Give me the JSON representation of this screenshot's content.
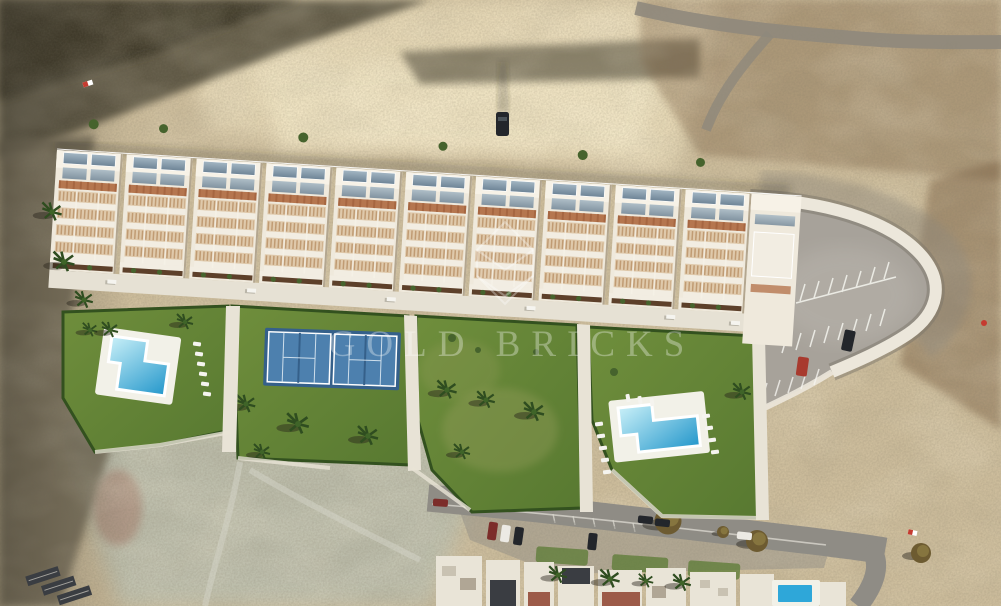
{
  "image": {
    "kind": "aerial-3d-render",
    "description": "Aerial render of a new hillside townhouse development with two L-shaped pools, two padel courts, landscaped gardens and a private parking lot, set in arid badlands above an existing residential street.",
    "watermark": {
      "text": "GOLD BRICKS",
      "logo": "gold-bricks-diamond-logo"
    }
  },
  "scene": {
    "counts": {
      "townhouse_blocks": 10,
      "pools": 2,
      "padel_courts": 2,
      "garden_plots": 4
    }
  },
  "palette": {
    "sand": "#cdbd9c",
    "sand_light": "#e6d8b6",
    "sand_bright": "#f1e5c4",
    "scrub_dark": "#55503e",
    "scrub_darker": "#3f3b2c",
    "pale_green": "#bcbfae",
    "left_slope": "#756c58",
    "brown_scrub": "#7d6244",
    "slope_grey": "#8f887c",
    "building_white": "#efe9dc",
    "roof_bright": "#f7f2e7",
    "glass_top": "#a3b6c3",
    "glass_bot": "#6e8496",
    "pergola": "#b5764f",
    "pergola_dark": "#9d5c38",
    "lattice": "#dfc9ab",
    "lattice_dot": "#b08456",
    "terrace_white": "#f2ede2",
    "planter": "#5d402a",
    "bush": "#46632d",
    "block_gap": "#b3a68f",
    "lawn": "#6f8e3c",
    "lawn_dark": "#587931",
    "lawn_dry": "#9aa05f",
    "hedge": "#33511f",
    "pool_light": "#c9f0f8",
    "pool_deep": "#2497cb",
    "deck": "#f2f1e8",
    "court": "#4d80ae",
    "court_dark": "#35608a",
    "court_line": "#dce9f2",
    "path": "#e8e3d6",
    "promenade": "#e6e1d4",
    "asphalt": "#a7a29a",
    "asphalt_light": "#b7b2aa",
    "wall": "#ece7db",
    "wall_shadow": "#7c756a",
    "stripe": "#f5f4ef",
    "car_dark": "#23262b",
    "car_red": "#a83a2e",
    "car_white": "#eceae4",
    "car_maroon": "#7c2d2a",
    "road": "#8f8c85",
    "road_line": "#d8d6cd",
    "roof_dark": "#3a3d42",
    "roof_red": "#9c5a48",
    "roof_white": "#e9e4d7",
    "small_pool": "#2ea7d9",
    "tree_olive": "#6d5b31",
    "tree_light": "#8b7a42",
    "palm_dark": "#2f4d20",
    "palm_mid": "#3f6428",
    "marker_red": "#c53b30",
    "shadow": "rgba(40,36,26,0.45)",
    "watermark": "rgba(255,255,255,0.33)"
  }
}
